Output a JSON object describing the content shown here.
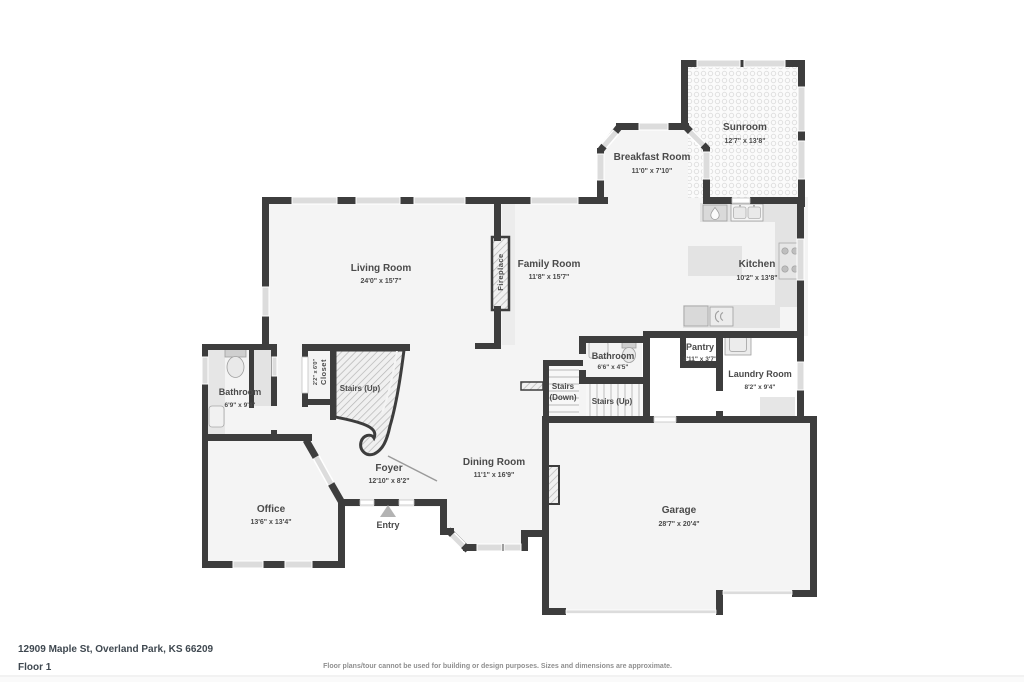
{
  "meta": {
    "address": "12909 Maple St, Overland Park, KS 66209",
    "floor_label": "Floor 1",
    "disclaimer": "Floor plans/tour cannot be used for building or design purposes. Sizes and dimensions are approximate."
  },
  "colors": {
    "wall": "#3d3d3d",
    "floor": "#f4f4f4",
    "window": "#dcdcdc",
    "counter": "#e3e3e3",
    "label": "#4a4a4a"
  },
  "rooms": {
    "living": {
      "name": "Living Room",
      "dims": "24'0\" x 15'7\""
    },
    "family": {
      "name": "Family Room",
      "dims": "11'8\" x 15'7\""
    },
    "breakfast": {
      "name": "Breakfast Room",
      "dims": "11'0\" x 7'10\""
    },
    "sunroom": {
      "name": "Sunroom",
      "dims": "12'7\" x 13'8\""
    },
    "kitchen": {
      "name": "Kitchen",
      "dims": "10'2\" x 13'8\""
    },
    "bathroom_main": {
      "name": "Bathroom",
      "dims": "6'9\" x 9'4\""
    },
    "bathroom_half": {
      "name": "Bathroom",
      "dims": "6'6\" x 4'5\""
    },
    "closet": {
      "name": "Closet",
      "dims": "2'2\" x 6'0\""
    },
    "stairs_spiral": {
      "name": "Stairs (Up)"
    },
    "stairs_down": {
      "line1": "Stairs",
      "line2": "(Down)"
    },
    "stairs_up": {
      "name": "Stairs (Up)"
    },
    "pantry": {
      "name": "Pantry",
      "dims": "3'11\" x 3'7\""
    },
    "laundry": {
      "name": "Laundry Room",
      "dims": "8'2\" x 9'4\""
    },
    "office": {
      "name": "Office",
      "dims": "13'6\" x 13'4\""
    },
    "foyer": {
      "name": "Foyer",
      "dims": "12'10\" x 8'2\""
    },
    "dining": {
      "name": "Dining Room",
      "dims": "11'1\" x 16'9\""
    },
    "entry": {
      "name": "Entry"
    },
    "garage": {
      "name": "Garage",
      "dims": "28'7\" x 20'4\""
    },
    "fireplace": {
      "name": "Fireplace"
    }
  }
}
